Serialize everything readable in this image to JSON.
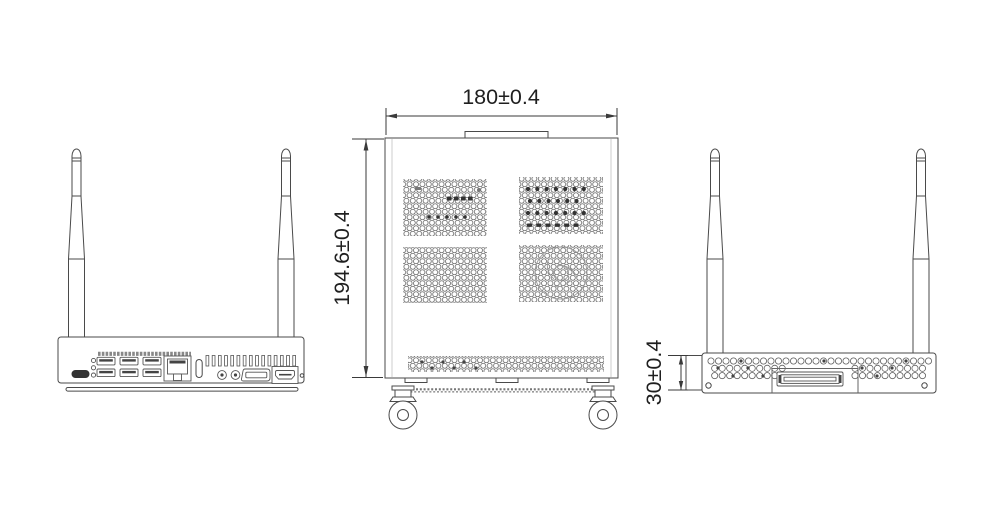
{
  "drawing": {
    "dimensions": {
      "width": "180±0.4",
      "height": "194.6±0.4",
      "depth": "30±0.4"
    },
    "colors": {
      "line": "#4a4a4a",
      "dim_text": "#1f1f1f",
      "background": "#ffffff"
    }
  }
}
